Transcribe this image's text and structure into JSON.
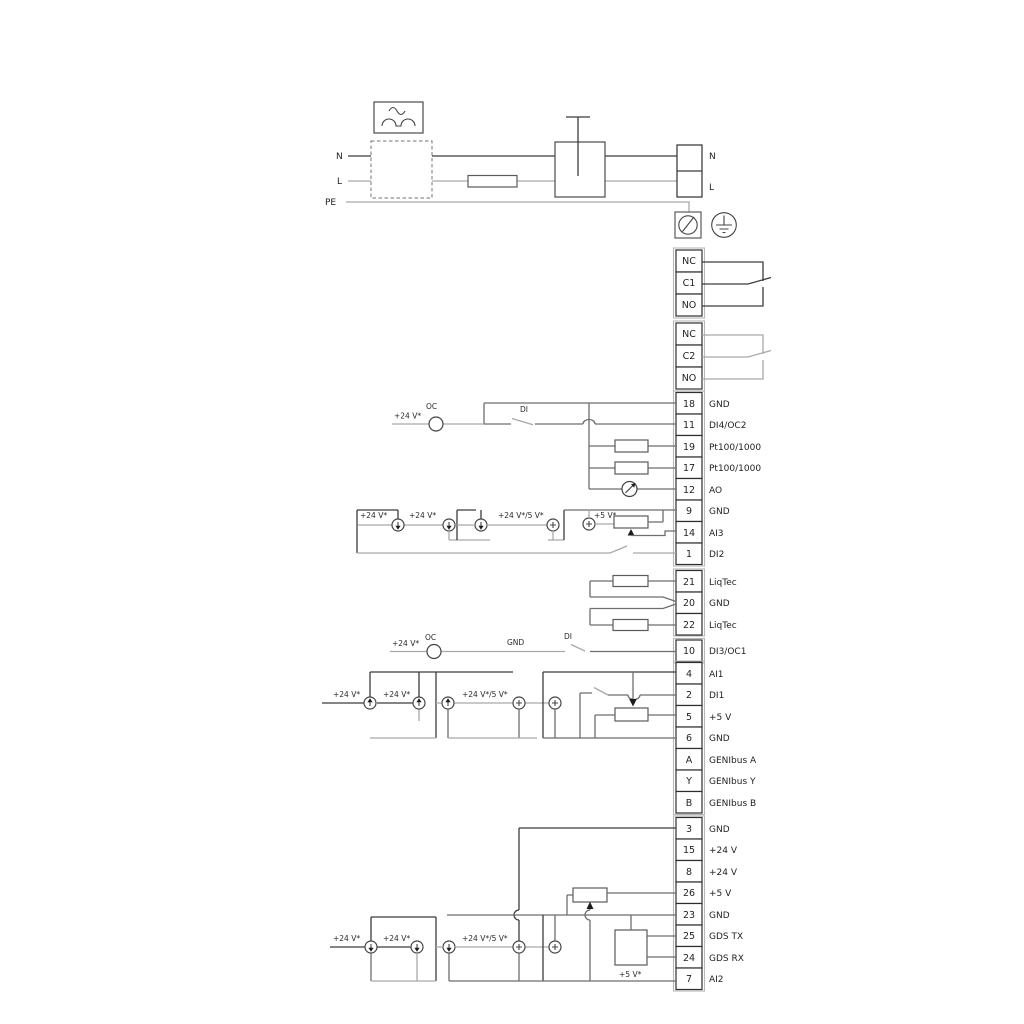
{
  "labels": {
    "v24": "+24 V*",
    "v24_5": "+24 V*/5 V*",
    "v5": "+5 V*",
    "oc": "OC",
    "di": "DI",
    "gnd": "GND"
  },
  "power": {
    "in": {
      "n": "N",
      "l": "L",
      "pe": "PE"
    },
    "out": {
      "n": "N",
      "l": "L"
    }
  },
  "relays": [
    {
      "terminals": [
        "NC",
        "C1",
        "NO"
      ]
    },
    {
      "terminals": [
        "NC",
        "C2",
        "NO"
      ]
    }
  ],
  "groups": {
    "io1": [
      {
        "num": "18",
        "label": "GND"
      },
      {
        "num": "11",
        "label": "DI4/OC2"
      },
      {
        "num": "19",
        "label": "Pt100/1000"
      },
      {
        "num": "17",
        "label": "Pt100/1000"
      },
      {
        "num": "12",
        "label": "AO"
      },
      {
        "num": "9",
        "label": "GND"
      },
      {
        "num": "14",
        "label": "AI3"
      },
      {
        "num": "1",
        "label": "DI2"
      }
    ],
    "liqtec": [
      {
        "num": "21",
        "label": "LiqTec"
      },
      {
        "num": "20",
        "label": "GND"
      },
      {
        "num": "22",
        "label": "LiqTec"
      }
    ],
    "di3": {
      "num": "10",
      "label": "DI3/OC1"
    },
    "io2": [
      {
        "num": "4",
        "label": "AI1"
      },
      {
        "num": "2",
        "label": "DI1"
      },
      {
        "num": "5",
        "label": "+5 V"
      },
      {
        "num": "6",
        "label": "GND"
      },
      {
        "num": "A",
        "label": "GENIbus A"
      },
      {
        "num": "Y",
        "label": "GENIbus Y"
      },
      {
        "num": "B",
        "label": "GENIbus B"
      }
    ],
    "io3": [
      {
        "num": "3",
        "label": "GND"
      },
      {
        "num": "15",
        "label": "+24 V"
      },
      {
        "num": "8",
        "label": "+24 V"
      },
      {
        "num": "26",
        "label": "+5 V"
      },
      {
        "num": "23",
        "label": "GND"
      },
      {
        "num": "25",
        "label": "GDS TX"
      },
      {
        "num": "24",
        "label": "GDS RX"
      },
      {
        "num": "7",
        "label": "AI2"
      }
    ]
  }
}
